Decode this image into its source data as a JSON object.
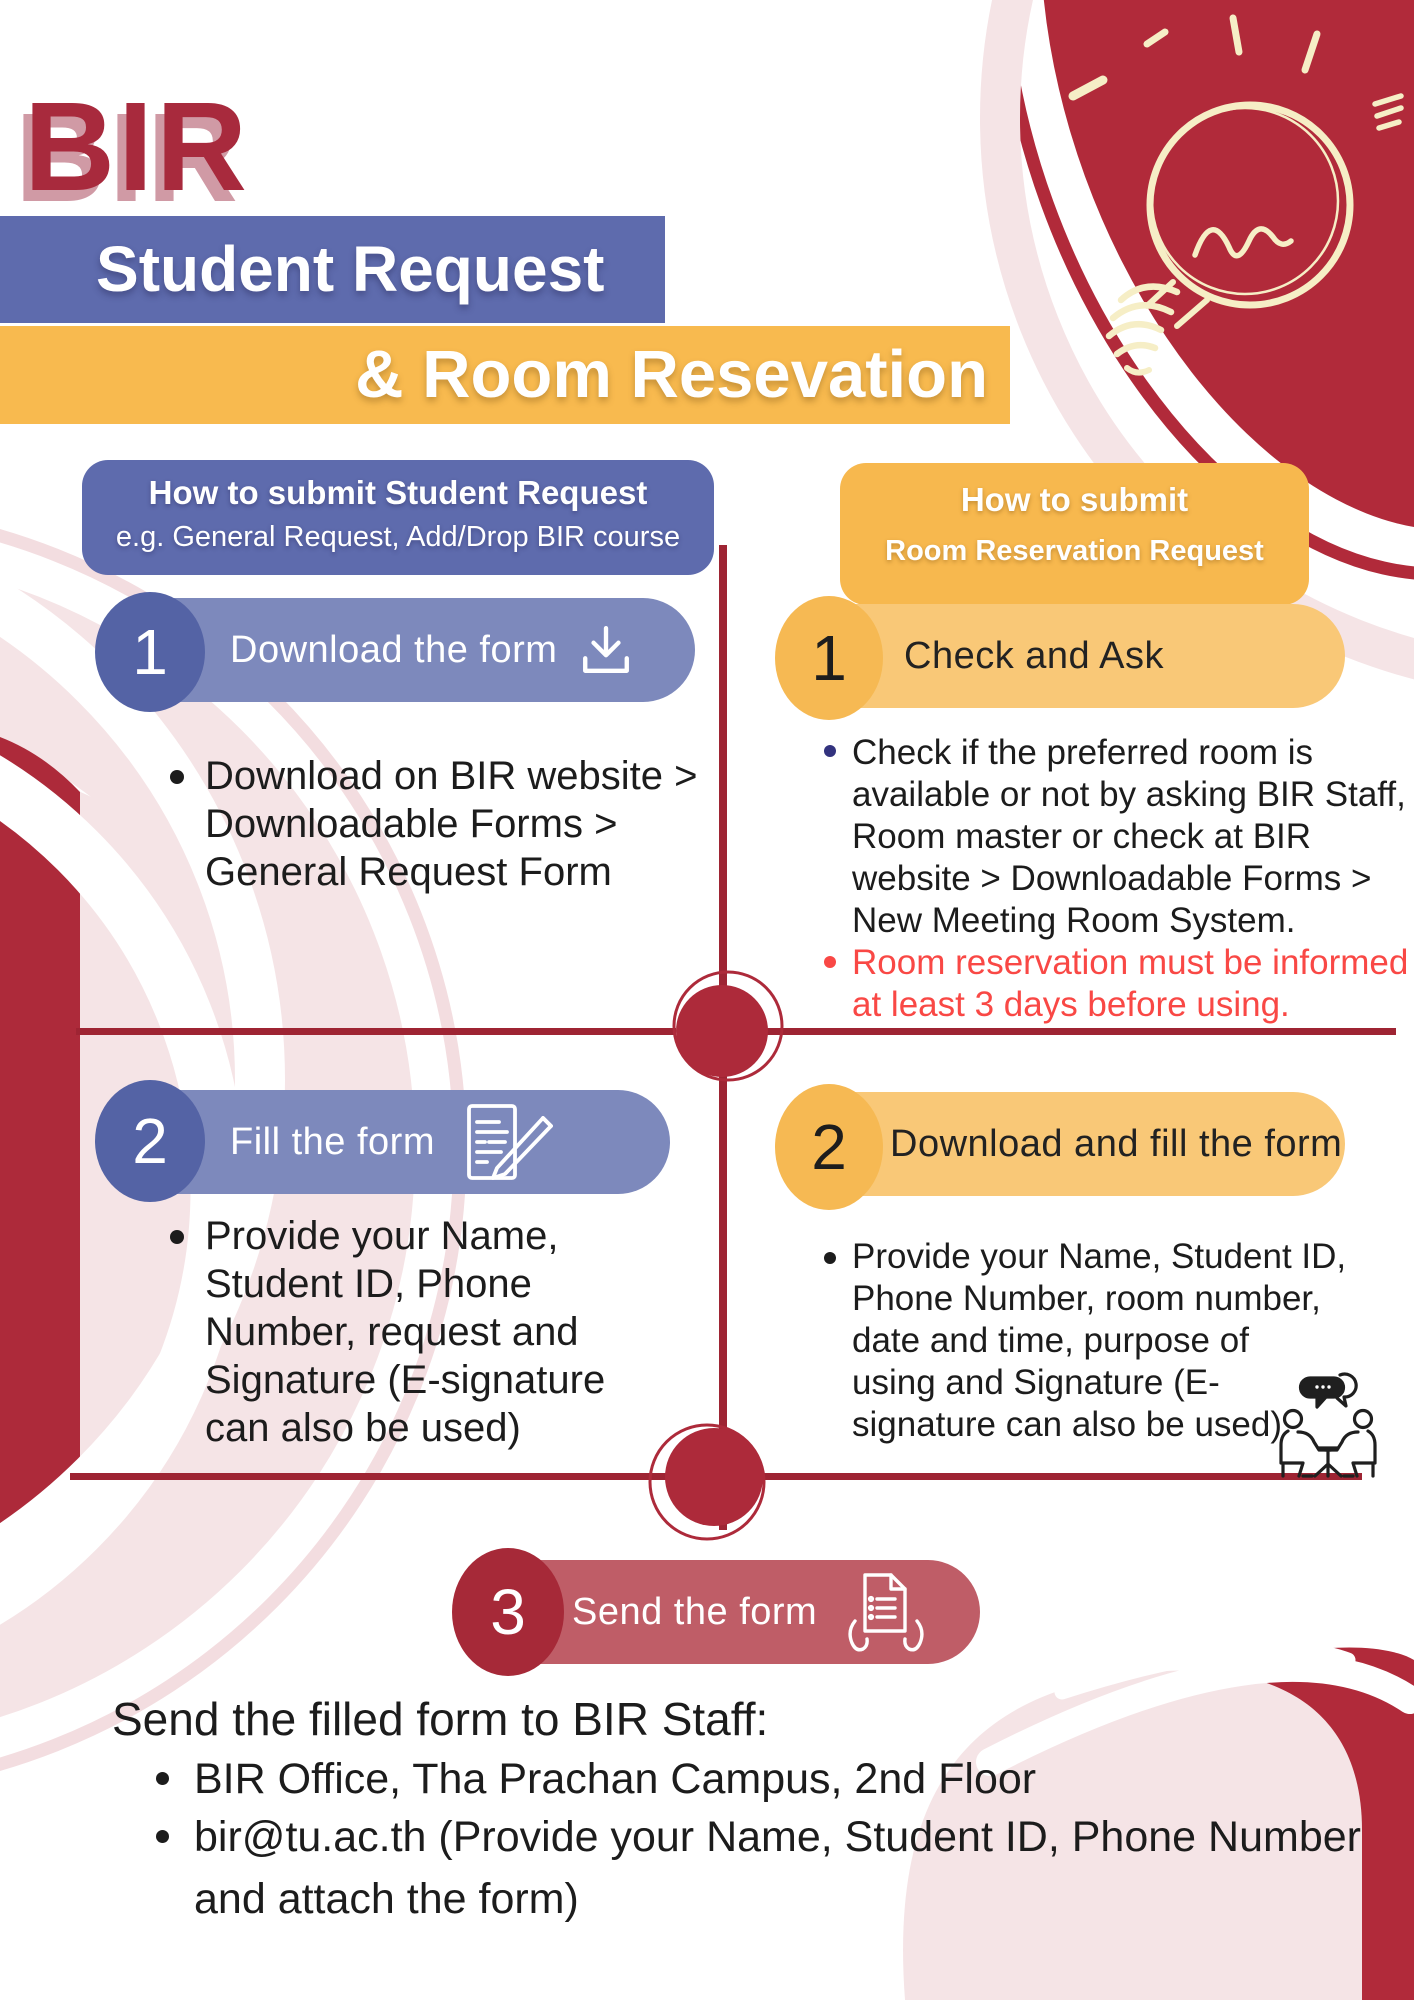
{
  "title": {
    "text": "BIR"
  },
  "banners": {
    "primary": "Student Request",
    "secondary": "& Room Resevation"
  },
  "left_column": {
    "header": {
      "line1": "How to submit Student Request",
      "line2": "e.g. General Request, Add/Drop BIR course"
    },
    "steps": [
      {
        "number": "1",
        "label": "Download the form",
        "icon": "download-icon",
        "bullets": [
          {
            "lines": [
              "Download on BIR website >",
              "Downloadable Forms >",
              "General Request Form"
            ]
          }
        ]
      },
      {
        "number": "2",
        "label": "Fill the form",
        "icon": "fill-form-icon",
        "bullets": [
          {
            "lines": [
              "Provide your Name,",
              "Student ID, Phone",
              "Number, request and",
              "Signature (E-signature",
              "can also be used)"
            ]
          }
        ]
      }
    ]
  },
  "right_column": {
    "header": {
      "line1": "How to submit",
      "line2": "Room Reservation Request"
    },
    "steps": [
      {
        "number": "1",
        "label": "Check and Ask",
        "bullets": [
          {
            "lines": [
              "Check if the preferred room is",
              "available or not by asking BIR Staff,",
              "Room master or check at BIR",
              "website > Downloadable Forms >",
              "New Meeting Room System."
            ]
          },
          {
            "lines": [
              "Room reservation must be informed",
              "at least 3 days before using."
            ]
          }
        ]
      },
      {
        "number": "2",
        "label": "Download and fill the form",
        "bullets": [
          {
            "lines": [
              "Provide your Name, Student ID,",
              "Phone Number, room number,",
              "date and time, purpose of",
              "using and Signature (E-",
              "signature can also be used)"
            ]
          }
        ]
      }
    ]
  },
  "final_step": {
    "number": "3",
    "label": "Send the form",
    "icon": "send-form-icon"
  },
  "footer": {
    "intro": "Send the filled form to BIR Staff:",
    "items": [
      {
        "lines": [
          "BIR Office, Tha Prachan Campus, 2nd Floor"
        ]
      },
      {
        "lines": [
          "bir@tu.ac.th (Provide your Name, Student ID, Phone Number",
          "and attach the form)"
        ]
      }
    ]
  },
  "icons": {
    "lightbulb": "lightbulb-doodle-icon",
    "people": "people-discussion-icon",
    "download": "download-icon",
    "fill_form": "fill-form-icon",
    "send_form": "send-form-icon"
  },
  "colors": {
    "dark_red": "#a82a3d",
    "line_red": "#9e2433",
    "purple": "#5e6bad",
    "purple_pill": "#7d89bc",
    "purple_bubble": "#5463a5",
    "yellow": "#f8ba4f",
    "yellow_pill": "#f9c877",
    "yellow_bubble": "#f6b953",
    "step3_pill": "#bf5d67",
    "step3_bubble": "#a62938",
    "alert_text": "#f94845",
    "navy_dot": "#32327e",
    "body_text": "#1c1c1c",
    "pale_pink": "#f5e4e6",
    "cream": "#f6eec6"
  }
}
